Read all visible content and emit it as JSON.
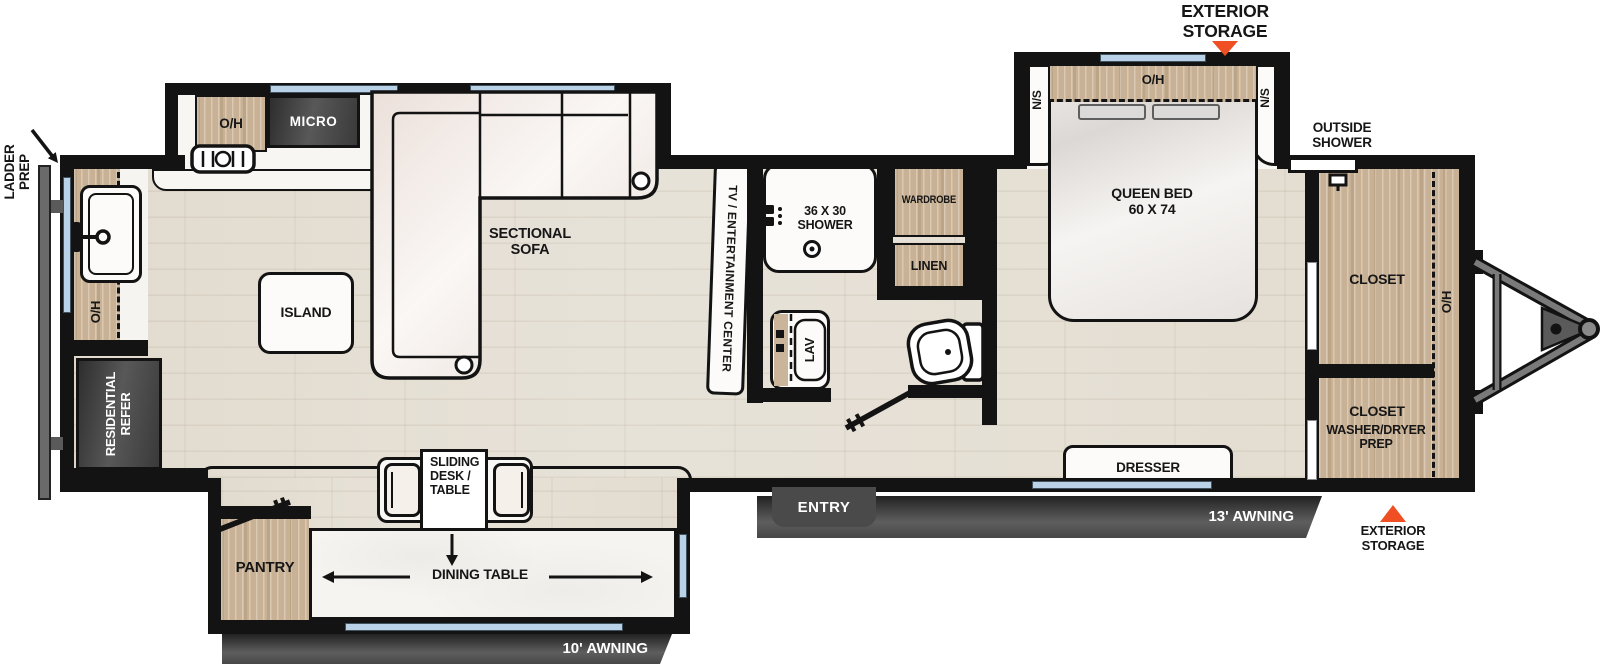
{
  "title": "Travel trailer floor plan",
  "colors": {
    "wall": "#131313",
    "cabinet_wood": "#c8b194",
    "window_blue": "#b9d2e8",
    "accent_orange": "#f04e23",
    "appliance_dark": "#3d3d3d",
    "floor_wood": "#e7e2d8"
  },
  "labels": {
    "ladder_prep": "LADDER\nPREP",
    "exterior_storage": "EXTERIOR\nSTORAGE",
    "outside_shower": "OUTSIDE\nSHOWER",
    "awning_10": "10' AWNING",
    "awning_13": "13' AWNING",
    "entry": "ENTRY",
    "oh": "O/H",
    "micro": "MICRO",
    "residential_refer": "RESIDENTIAL\nREFER",
    "island": "ISLAND",
    "sectional_sofa": "SECTIONAL\nSOFA",
    "tv_center": "TV / ENTERTAINMENT CENTER",
    "pantry": "PANTRY",
    "sliding_desk": "SLIDING\nDESK /\nTABLE",
    "dining_table": "DINING TABLE",
    "shower": "36 X 30\nSHOWER",
    "wardrobe": "WARDROBE",
    "linen": "LINEN",
    "lav": "LAV",
    "queen_bed": "QUEEN BED\n60 X 74",
    "ns": "N/S",
    "dresser": "DRESSER",
    "closet": "CLOSET",
    "washer_dryer": "WASHER/DRYER\nPREP"
  }
}
